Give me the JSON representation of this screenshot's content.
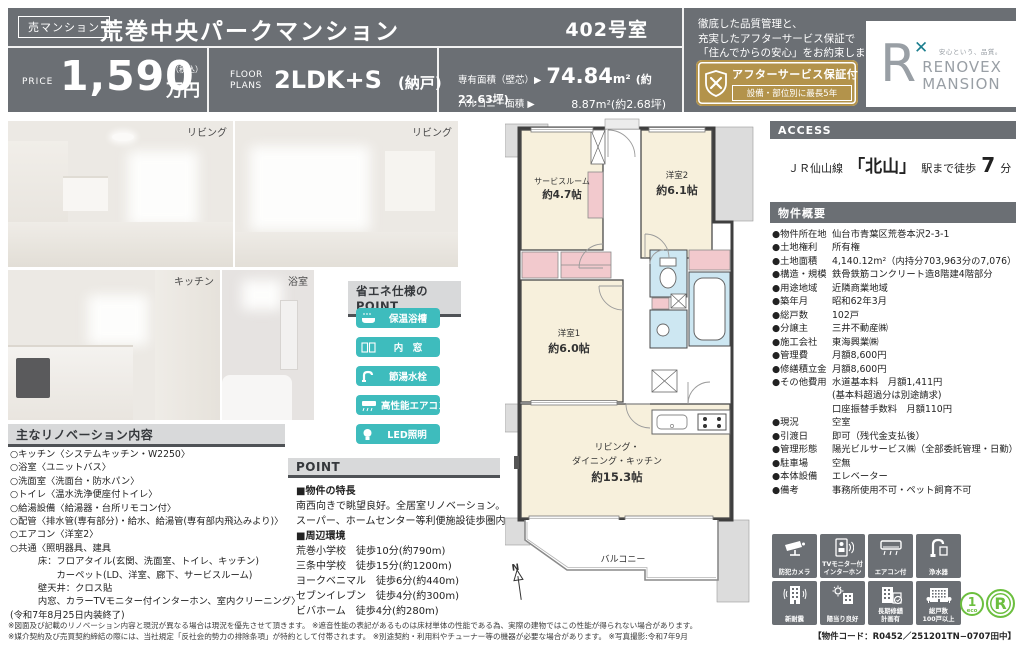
{
  "header": {
    "category_badge": "売マンション",
    "title": "荒巻中央パークマンション",
    "room_no": "402号室",
    "price_label": "PRICE",
    "price_value": "1,590",
    "price_tax": "（税込）",
    "price_unit": "万円",
    "floor_label1": "FLOOR",
    "floor_label2": "PLANS",
    "floor_value": "2LDK+S",
    "floor_suffix": "(納戸)",
    "area_label": "専有面積（壁芯）▶",
    "area_value": "74.84",
    "area_unit": "m²",
    "area_tsubo": "(約22.63坪)",
    "balcony_label": "バルコニー面積 ▶",
    "balcony_value": "8.87m²",
    "balcony_tsubo": "(約2.68坪)",
    "quality_line1": "徹底した品質管理と、",
    "quality_line2": "充実したアフターサービス保証で",
    "quality_line3": "「住んでからの安心」をお約束します。",
    "warranty_title": "アフターサービス保証付",
    "warranty_sub": "設備・部位別に最長5年",
    "logo_mark": "R",
    "logo_x": "✕",
    "logo_tagline": "安心という、品質。",
    "logo_name1": "RENOVEX",
    "logo_name2": "MANSION"
  },
  "photos": {
    "p1": "リビング",
    "p2": "リビング",
    "p3": "キッチン",
    "p4": "浴室"
  },
  "eco": {
    "title": "省エネ仕様のPOINT",
    "b1": "保温浴槽",
    "b2": "内　窓",
    "b3": "節湯水栓",
    "b4": "高性能エアコン",
    "b5": "LED照明"
  },
  "renovation": {
    "title": "主なリノベーション内容",
    "items": [
      "○キッチン〈システムキッチン・W2250〉",
      "○浴室〈ユニットバス〉",
      "○洗面室〈洗面台・防水パン〉",
      "○トイレ〈温水洗浄便座付トイレ〉",
      "○給湯設備〈給湯器・台所リモコン付〉",
      "○配管〈排水管(専有部分)・給水、給湯管(専有部内飛込みより)〉",
      "○エアコン〈洋室2〉",
      "○共通〈照明器具、建具",
      "　　　床：フロアタイル(玄関、洗面室、トイレ、キッチン)",
      "　　　　　カーペット(LD、洋室、廊下、サービスルーム)",
      "　　　壁天井：クロス貼",
      "　　　内窓、カラーTVモニター付インターホン、室内クリーニング〉",
      "(令和7年8月25日内装終了)"
    ]
  },
  "point": {
    "title": "POINT",
    "h1": "■物件の特長",
    "f1": "南西向きで眺望良好。全居室リノベーション。",
    "f2": "スーパー、ホームセンター等利便施設徒歩圏内",
    "h2": "■周辺環境",
    "s1": "荒巻小学校　徒歩10分(約790m)",
    "s2": "三条中学校　徒歩15分(約1200m)",
    "s3": "ヨークベニマル　徒歩6分(約440m)",
    "s4": "セブンイレブン　徒歩4分(約300m)",
    "s5": "ビバホーム　徒歩4分(約280m)"
  },
  "access": {
    "title": "ACCESS",
    "line": "ＪＲ仙山線",
    "station": "「北山」",
    "mid": "駅まで徒歩",
    "min": "7",
    "suffix": "分"
  },
  "outline": {
    "title": "物件概要",
    "rows": [
      {
        "label": "●物件所在地",
        "value": "仙台市青葉区荒巻本沢2-3-1"
      },
      {
        "label": "●土地権利",
        "value": "所有権"
      },
      {
        "label": "●土地面積",
        "value": "4,140.12m²（内持分703,963分の7,076）"
      },
      {
        "label": "●構造・規模",
        "value": "鉄骨鉄筋コンクリート造8階建4階部分"
      },
      {
        "label": "●用途地域",
        "value": "近隣商業地域"
      },
      {
        "label": "●築年月",
        "value": "昭和62年3月"
      },
      {
        "label": "●総戸数",
        "value": "102戸"
      },
      {
        "label": "●分譲主",
        "value": "三井不動産㈱"
      },
      {
        "label": "●施工会社",
        "value": "東海興業㈱"
      },
      {
        "label": "●管理費",
        "value": "月額8,600円"
      },
      {
        "label": "●修繕積立金",
        "value": "月額8,600円"
      },
      {
        "label": "●その他費用",
        "value": "水道基本料　月額1,411円"
      },
      {
        "label": "",
        "value": "(基本料超過分は別途請求)"
      },
      {
        "label": "",
        "value": "口座振替手数料　月額110円"
      },
      {
        "label": "●現況",
        "value": "空室"
      },
      {
        "label": "●引渡日",
        "value": "即可（残代金支払後）"
      },
      {
        "label": "●管理形態",
        "value": "陽光ビルサービス㈱（全部委託管理・日勤）"
      },
      {
        "label": "●駐車場",
        "value": "空無"
      },
      {
        "label": "●本体設備",
        "value": "エレベーター"
      },
      {
        "label": "●備考",
        "value": "事務所使用不可・ペット飼育不可"
      }
    ]
  },
  "floorplan": {
    "service_name": "サービスルーム",
    "service_size": "約4.7帖",
    "bed2_name": "洋室2",
    "bed2_size": "約6.1帖",
    "bed1_name": "洋室1",
    "bed1_size": "約6.0帖",
    "ldk_line1": "リビング・",
    "ldk_line2": "ダイニング・キッチン",
    "ldk_size": "約15.3帖",
    "balcony": "バルコニー",
    "north": "N"
  },
  "amenities": {
    "a1": "防犯カメラ",
    "a2": "TVモニター付\nインターホン",
    "a3": "エアコン付",
    "a4": "浄水器",
    "a5": "新耐震",
    "a6": "陽当り良好",
    "a7": "長期修繕\n計画有",
    "a8": "総戸数\n100戸以上"
  },
  "marks": {
    "eco_num": "1",
    "eco_text": "eco",
    "r_mark": "R"
  },
  "footer": {
    "line1": "※図面及び記載のリノベーション内容と現況が異なる場合は現況を優先させて頂きます。 ※遮音性能の表記があるものは床材単体の性能である為、実際の建物ではこの性能が得られない場合があります。",
    "line2": "※媒介契約及び売買契約締結の際には、当社規定「反社会的勢力の排除条項」が特約として付帯されます。 ※別途契約・利用料やチューナー等の機器が必要な場合があります。 ※写真撮影:令和7年9月",
    "property_code": "【物件コード：R0452／251201TN−0707田中】"
  }
}
